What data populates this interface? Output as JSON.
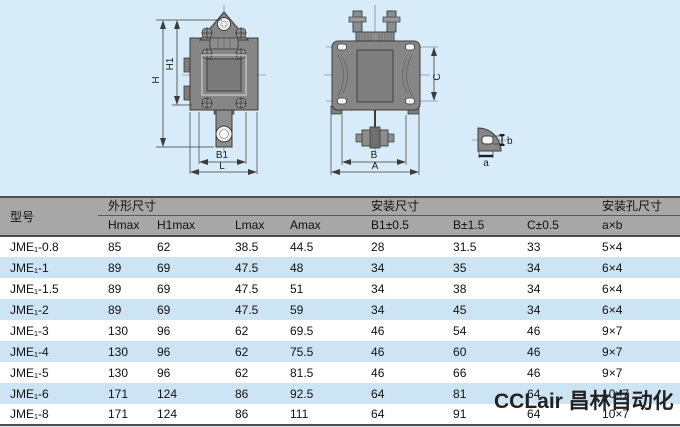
{
  "drawings": {
    "front": {
      "h": "H",
      "h1": "H1",
      "b1": "B1",
      "l": "L"
    },
    "side": {
      "c": "C",
      "b": "B",
      "a": "A"
    },
    "detail": {
      "a": "a",
      "b": "b"
    }
  },
  "table": {
    "model_header": "型号",
    "groups": [
      {
        "label": "外形尺寸"
      },
      {
        "label": "安装尺寸"
      },
      {
        "label": "安装孔尺寸"
      }
    ],
    "columns": [
      "Hmax",
      "H1max",
      "Lmax",
      "Amax",
      "B1±0.5",
      "B±1.5",
      "C±0.5",
      "a×b"
    ],
    "rows": [
      {
        "model": "JME₁-0.8",
        "values": [
          "85",
          "62",
          "38.5",
          "44.5",
          "28",
          "31.5",
          "33",
          "5×4"
        ]
      },
      {
        "model": "JME₁-1",
        "values": [
          "89",
          "69",
          "47.5",
          "48",
          "34",
          "35",
          "34",
          "6×4"
        ]
      },
      {
        "model": "JME₁-1.5",
        "values": [
          "89",
          "69",
          "47.5",
          "51",
          "34",
          "38",
          "34",
          "6×4"
        ]
      },
      {
        "model": "JME₁-2",
        "values": [
          "89",
          "69",
          "47.5",
          "59",
          "34",
          "45",
          "34",
          "6×4"
        ]
      },
      {
        "model": "JME₁-3",
        "values": [
          "130",
          "96",
          "62",
          "69.5",
          "46",
          "54",
          "46",
          "9×7"
        ]
      },
      {
        "model": "JME₁-4",
        "values": [
          "130",
          "96",
          "62",
          "75.5",
          "46",
          "60",
          "46",
          "9×7"
        ]
      },
      {
        "model": "JME₁-5",
        "values": [
          "130",
          "96",
          "62",
          "81.5",
          "46",
          "66",
          "46",
          "9×7"
        ]
      },
      {
        "model": "JME₁-6",
        "values": [
          "171",
          "124",
          "86",
          "92.5",
          "64",
          "81",
          "64",
          "10×7"
        ]
      },
      {
        "model": "JME₁-8",
        "values": [
          "171",
          "124",
          "86",
          "111",
          "64",
          "91",
          "64",
          "10×7"
        ]
      }
    ]
  },
  "watermark": "CCLair 昌林自动化",
  "colors": {
    "page_background": "#d7ebf9",
    "header_gray": "#a7a7a7",
    "row_stripe_blue": "#cde4f4",
    "row_white": "#ffffff",
    "border_dark": "#4d4d4d",
    "drawing_gray": "#868686",
    "drawing_stroke": "#3c3c3c",
    "watermark_color": "#222222"
  }
}
